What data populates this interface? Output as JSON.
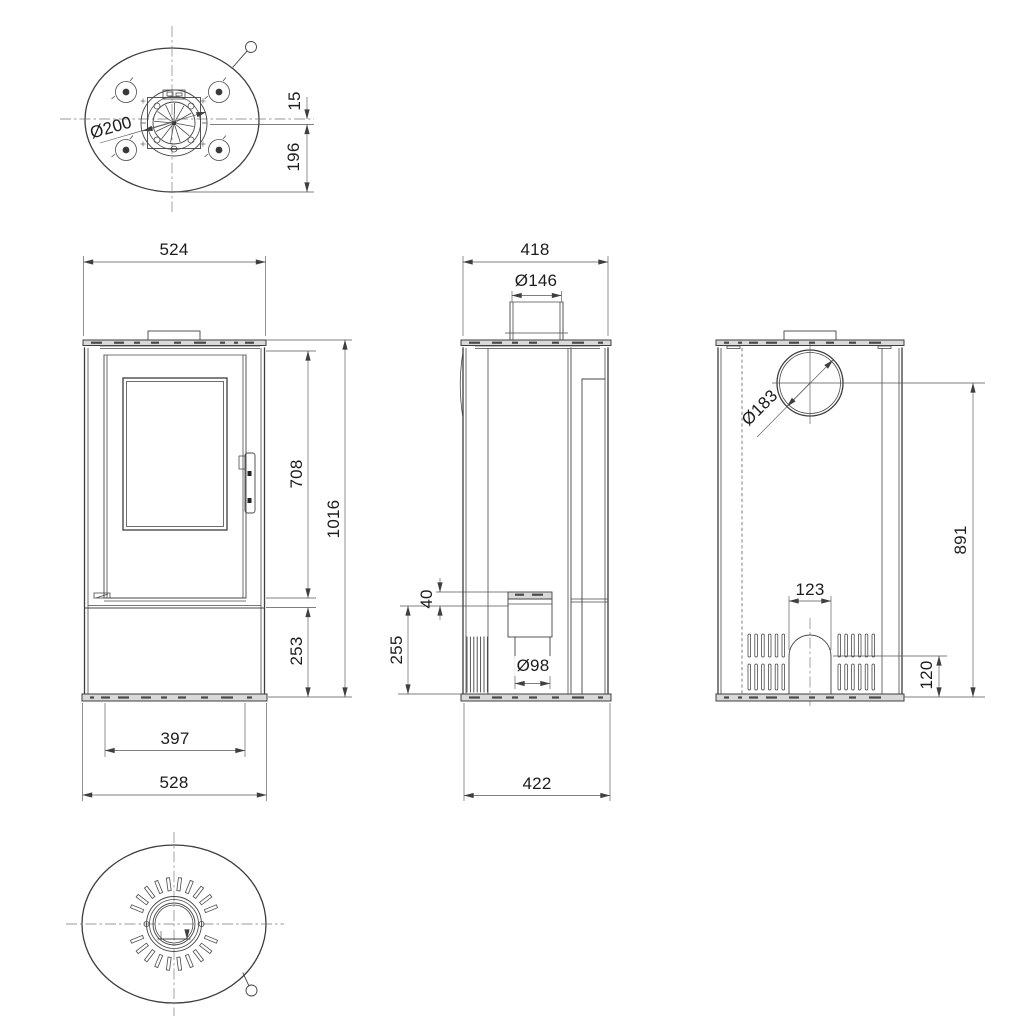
{
  "dims": {
    "top_view": {
      "flue_collar": "Ø200",
      "flue_offset": "15",
      "flue_to_rear": "196"
    },
    "front_view": {
      "top_width": "524",
      "body_height": "708",
      "total_height": "1016",
      "base_height": "253",
      "pedestal_width": "397",
      "base_width": "528"
    },
    "side_view": {
      "top_depth": "418",
      "flue_pipe": "Ø146",
      "intake_drop": "40",
      "intake_height": "255",
      "intake_pipe": "Ø98",
      "base_depth": "422"
    },
    "back_view": {
      "flue_outlet": "Ø183",
      "flue_center_height": "891",
      "arch_width": "123",
      "arch_height": "120"
    }
  }
}
